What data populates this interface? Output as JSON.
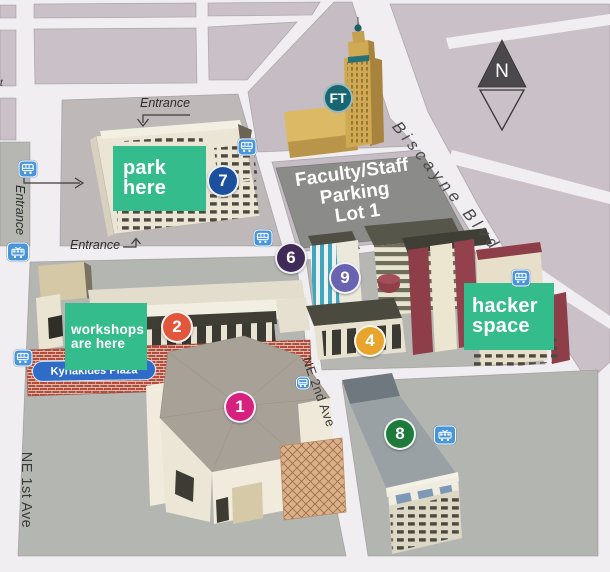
{
  "streets": {
    "biscayne_blvd": "Biscayne Blvd",
    "ne_2nd_ave": "NE 2nd Ave",
    "ne_1st_ave": "NE 1st Ave",
    "edge_fragment": "t"
  },
  "annotations": {
    "park_here": {
      "line1": "park",
      "line2": "here",
      "color": "#35bc8d"
    },
    "workshops": {
      "line1": "workshops",
      "line2": "are here",
      "color": "#35bc8d"
    },
    "hacker_space": {
      "line1": "hacker",
      "line2": "space",
      "color": "#35bc8d"
    }
  },
  "places": {
    "parking_lot": {
      "line1": "Faculty/Staff",
      "line2": "Parking",
      "line3": "Lot 1"
    },
    "kyriakides_plaza": "Kyriakides Plaza",
    "freedom_tower_badge": "FT",
    "entrance": "Entrance"
  },
  "compass": {
    "north_label": "N"
  },
  "markers": [
    {
      "number": "1",
      "color": "#d6217e"
    },
    {
      "number": "2",
      "color": "#e2573b"
    },
    {
      "number": "4",
      "color": "#e9a42d"
    },
    {
      "number": "6",
      "color": "#402a58"
    },
    {
      "number": "7",
      "color": "#1d4f9f"
    },
    {
      "number": "8",
      "color": "#1e7a3a"
    },
    {
      "number": "9",
      "color": "#6a63b2"
    }
  ],
  "transit_stops": [
    {
      "type": "bus"
    },
    {
      "type": "bus"
    },
    {
      "type": "tram"
    },
    {
      "type": "bus"
    },
    {
      "type": "bus"
    },
    {
      "type": "bus"
    },
    {
      "type": "tram"
    },
    {
      "type": "bus"
    }
  ],
  "icons": {
    "bus_stop": "bus-icon",
    "tram_stop": "tram-icon",
    "north": "compass-icon"
  },
  "colors": {
    "label_green": "#35bc8d",
    "transit_blue": "#4796dc",
    "plaza_label_blue": "#2e6cc8",
    "ft_teal": "#176671",
    "parking_lot_gray": "#8b8b89",
    "road": "#f1eef1",
    "city_block_pink": "#cac0c7",
    "campus_block_gray": "#b6b7b2"
  }
}
